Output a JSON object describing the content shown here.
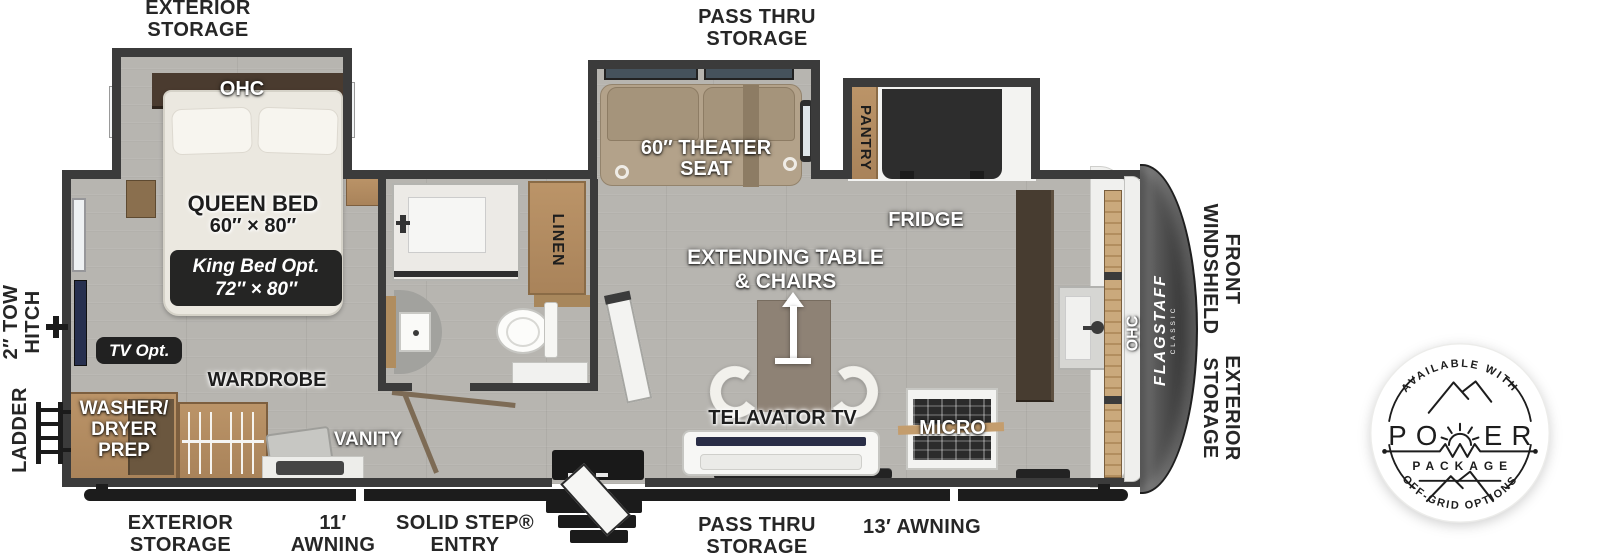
{
  "exterior": {
    "storage_top": {
      "l1": "EXTERIOR",
      "l2": "STORAGE"
    },
    "pass_thru_top": {
      "l1": "PASS THRU",
      "l2": "STORAGE"
    },
    "tow_hitch": {
      "l1": "2″ TOW",
      "l2": "HITCH"
    },
    "ladder": {
      "text": "LADDER"
    },
    "front_windshield": {
      "l1": "FRONT",
      "l2": "WINDSHIELD"
    },
    "storage_right": {
      "l1": "EXTERIOR",
      "l2": "STORAGE"
    },
    "storage_bottom": {
      "l1": "EXTERIOR",
      "l2": "STORAGE"
    },
    "awning_11": {
      "l1": "11′",
      "l2": "AWNING"
    },
    "solid_step": {
      "l1": "SOLID STEP®",
      "l2": "ENTRY"
    },
    "pass_thru_bottom": {
      "l1": "PASS THRU",
      "l2": "STORAGE"
    },
    "awning_13": {
      "text": "13′ AWNING"
    }
  },
  "interior": {
    "ohc_bedroom": {
      "text": "OHC"
    },
    "queen_bed": {
      "l1": "QUEEN BED",
      "l2": "60″ × 80″"
    },
    "king_bed_opt": {
      "l1": "King Bed Opt.",
      "l2": "72″ × 80″"
    },
    "tv_opt": {
      "text": "TV Opt."
    },
    "wardrobe": {
      "text": "WARDROBE"
    },
    "washer_dryer": {
      "l1": "WASHER/",
      "l2": "DRYER",
      "l3": "PREP"
    },
    "vanity": {
      "text": "VANITY"
    },
    "linen": {
      "text": "LINEN"
    },
    "theater_seat": {
      "l1": "60″ THEATER",
      "l2": "SEAT"
    },
    "pantry": {
      "text": "PANTRY"
    },
    "fridge": {
      "text": "FRIDGE"
    },
    "extending_table": {
      "l1": "EXTENDING TABLE",
      "l2": "& CHAIRS"
    },
    "telavator_tv": {
      "text": "TELAVATOR TV"
    },
    "micro": {
      "text": "MICRO"
    },
    "ohc_front": {
      "text": "OHC"
    },
    "flagstaff": {
      "text": "FLAGSTAFF",
      "sub": "CLASSIC"
    }
  },
  "power_badge": {
    "arc_top": "AVAILABLE WITH",
    "power_left": "PO",
    "power_right": "ER",
    "package": "PACKAGE",
    "arc_bottom": "OFF-GRID OPTIONS"
  },
  "colors": {
    "wall": "#3b3b3b",
    "floor_wood": "#b7b5b0",
    "cabinet_wood": "#b28e5f",
    "dark_accent": "#1d1d1d",
    "cap_gray": "#4a4a4a",
    "badge_ink": "#1d1d1d"
  }
}
